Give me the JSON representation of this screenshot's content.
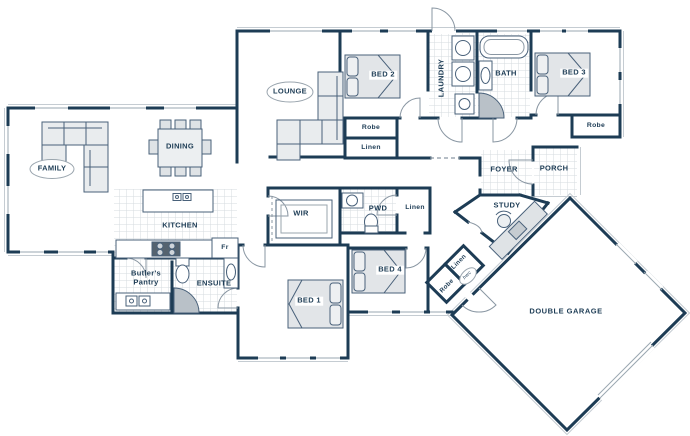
{
  "palette": {
    "wall": "#1d3c55",
    "label_text": "#1d3c55",
    "furniture_fill": "#e6e9ec",
    "tile_line": "#d6dbdf",
    "thin_line": "#8a97a3"
  },
  "rooms": {
    "family": "FAMILY",
    "dining": "DINING",
    "lounge": "LOUNGE",
    "kitchen": "KITCHEN",
    "fridge": "Fr",
    "butlers_pantry": "Butler's Pantry",
    "ensuite": "ENSUITE",
    "wir": "WIR",
    "bed1": "BED 1",
    "bed2": "BED 2",
    "bed3": "BED 3",
    "bed4": "BED 4",
    "robe_bed2": "Robe",
    "linen_bed2": "Linen",
    "laundry": "LAUNDRY",
    "bath": "BATH",
    "robe_bed3": "Robe",
    "pwd": "PWD",
    "linen_hall": "Linen",
    "foyer": "FOYER",
    "porch": "PORCH",
    "study": "STUDY",
    "linen_garage": "Linen",
    "hwc": "hwc",
    "robe_garage": "Robe",
    "double_garage": "DOUBLE GARAGE"
  }
}
